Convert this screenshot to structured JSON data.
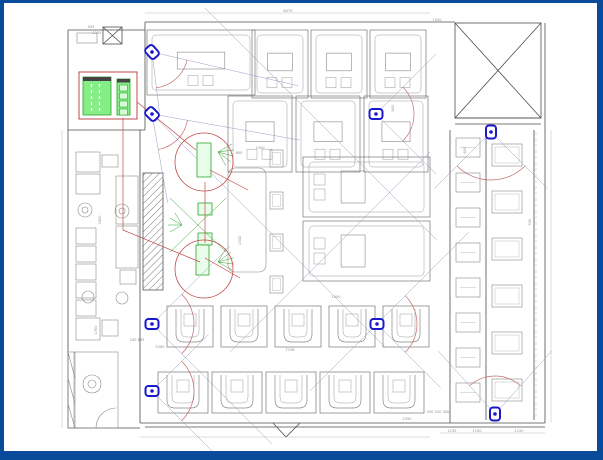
{
  "drawing": {
    "title": "security-camera-floor-plan",
    "colors": {
      "frame_blue": "#0a4a9b",
      "wall": "#4d4d4d",
      "furniture": "#8a8a8a",
      "light": "#b0b0b0",
      "camera_blue": "#1a1acc",
      "fov_line": "#9a9ac8",
      "arc_red": "#c46a6a",
      "annot_red": "#c04848",
      "green_fill": "#86ee86",
      "green_stroke": "#2da52d",
      "green_light": "#d9fbd9",
      "dim_text": "#909090",
      "dim_line": "#aaaaaa",
      "header_bar": "#444444"
    },
    "cameras": [
      {
        "id": "cam-1",
        "x": 152,
        "y": 52,
        "dir": 48,
        "half": 35,
        "len_a": 150,
        "len_b": 60,
        "arc_r": 36
      },
      {
        "id": "cam-2",
        "x": 152,
        "y": 114,
        "dir": 45,
        "half": 35,
        "len_a": 150,
        "len_b": 90,
        "arc_r": 36
      },
      {
        "id": "cam-3",
        "x": 376,
        "y": 114,
        "dir": 0,
        "half": 45,
        "len_a": 85,
        "len_b": 85,
        "arc_r": 38
      },
      {
        "id": "cam-4",
        "x": 491,
        "y": 132,
        "dir": 90,
        "half": 45,
        "len_a": 80,
        "len_b": 80,
        "arc_r": 48
      },
      {
        "id": "cam-5",
        "x": 152,
        "y": 324,
        "dir": 0,
        "half": 45,
        "len_a": 110,
        "len_b": 170,
        "arc_r": 42
      },
      {
        "id": "cam-6",
        "x": 377,
        "y": 324,
        "dir": 0,
        "half": 45,
        "len_a": 130,
        "len_b": 90,
        "arc_r": 40
      },
      {
        "id": "cam-7",
        "x": 152,
        "y": 391,
        "dir": 0,
        "half": 45,
        "len_a": 80,
        "len_b": 92,
        "arc_r": 42
      },
      {
        "id": "cam-8",
        "x": 495,
        "y": 414,
        "dir": -90,
        "half": 42,
        "len_a": 85,
        "len_b": 85,
        "arc_r": 38
      }
    ],
    "sight_lines": [
      [
        205,
        8,
        437,
        240
      ],
      [
        152,
        114,
        385,
        347
      ],
      [
        430,
        152,
        230,
        352
      ],
      [
        469,
        232,
        310,
        391
      ]
    ],
    "booth_rows": [
      {
        "style": "A",
        "x": 147,
        "y": 30,
        "w": 108,
        "h": 65,
        "count": 1,
        "gap": 0,
        "stack": "h"
      },
      {
        "style": "A",
        "x": 252,
        "y": 30,
        "w": 56,
        "h": 68,
        "count": 3,
        "gap": 3,
        "stack": "h"
      },
      {
        "style": "A",
        "x": 228,
        "y": 96,
        "w": 64,
        "h": 76,
        "count": 3,
        "gap": 4,
        "stack": "h"
      },
      {
        "style": "M",
        "x": 303,
        "y": 157,
        "w": 127,
        "h": 60,
        "count": 2,
        "gap": 4,
        "stack": "v"
      },
      {
        "style": "T",
        "x": 270,
        "y": 150,
        "w": 13,
        "h": 17,
        "count": 4,
        "gap": 25,
        "stack": "v"
      },
      {
        "style": "U",
        "x": 167,
        "y": 306,
        "w": 46,
        "h": 41,
        "count": 5,
        "gap": 8,
        "stack": "h"
      },
      {
        "style": "U",
        "x": 158,
        "y": 372,
        "w": 50,
        "h": 41,
        "count": 5,
        "gap": 4,
        "stack": "h"
      },
      {
        "style": "R1",
        "x": 456,
        "y": 138,
        "w": 24,
        "h": 19,
        "count": 8,
        "gap": 16,
        "stack": "v"
      },
      {
        "style": "R2",
        "x": 492,
        "y": 144,
        "w": 30,
        "h": 22,
        "count": 6,
        "gap": 25,
        "stack": "v"
      }
    ],
    "legend": {
      "box": [
        79,
        72,
        58,
        47
      ],
      "green_table": [
        83,
        77,
        28,
        38
      ],
      "green_column": [
        117,
        79,
        13,
        36
      ],
      "column_cells": [
        [
          119.5,
          85,
          8,
          6
        ],
        [
          119.5,
          93,
          8,
          6
        ],
        [
          119.5,
          101,
          8,
          6
        ],
        [
          119.5,
          109,
          8,
          6
        ]
      ]
    },
    "red_circles": [
      {
        "cx": 204,
        "cy": 162,
        "r": 29
      },
      {
        "cx": 204,
        "cy": 269,
        "r": 29
      }
    ],
    "red_lines": [
      [
        123,
        118,
        123,
        230
      ],
      [
        123,
        230,
        200,
        262
      ],
      [
        137,
        102,
        196,
        150
      ],
      [
        205,
        182,
        205,
        243
      ],
      [
        210,
        170,
        248,
        190
      ],
      [
        205,
        258,
        240,
        278
      ]
    ],
    "green_rects": [
      [
        197,
        143,
        14,
        34
      ],
      [
        198,
        203,
        14,
        12
      ],
      [
        198,
        233,
        14,
        12
      ],
      [
        196,
        245,
        13,
        30
      ]
    ],
    "green_lines": [
      [
        170,
        198,
        226,
        252
      ],
      [
        226,
        198,
        170,
        252
      ]
    ],
    "green_fans": [
      {
        "cx": 218,
        "cy": 152,
        "a0": -30,
        "a1": 60,
        "n": 5,
        "r": 16
      },
      {
        "cx": 218,
        "cy": 262,
        "a0": -60,
        "a1": 30,
        "n": 5,
        "r": 16
      },
      {
        "cx": 182,
        "cy": 225,
        "a0": 150,
        "a1": 240,
        "n": 4,
        "r": 14
      }
    ],
    "dimensions": [
      {
        "t": "8070",
        "x": 288,
        "y": 12,
        "r": 0
      },
      {
        "t": "1500",
        "x": 437,
        "y": 21,
        "r": 0
      },
      {
        "t": "943",
        "x": 91,
        "y": 28,
        "r": 0
      },
      {
        "t": "1205",
        "x": 97,
        "y": 34,
        "r": 0
      },
      {
        "t": "3400",
        "x": 101,
        "y": 220,
        "r": -90
      },
      {
        "t": "1700",
        "x": 97,
        "y": 330,
        "r": -90
      },
      {
        "t": "2042",
        "x": 241,
        "y": 240,
        "r": -90
      },
      {
        "t": "600",
        "x": 239,
        "y": 154,
        "r": 0
      },
      {
        "t": "1500",
        "x": 260,
        "y": 149,
        "r": 0
      },
      {
        "t": "800",
        "x": 394,
        "y": 108,
        "r": -90
      },
      {
        "t": "600",
        "x": 466,
        "y": 150,
        "r": -90
      },
      {
        "t": "930",
        "x": 531,
        "y": 222,
        "r": -90
      },
      {
        "t": "1400",
        "x": 336,
        "y": 298,
        "r": 0
      },
      {
        "t": "5280",
        "x": 160,
        "y": 348,
        "r": 0
      },
      {
        "t": "7158",
        "x": 290,
        "y": 351,
        "r": 0
      },
      {
        "t": "240 895",
        "x": 137,
        "y": 341,
        "r": 0
      },
      {
        "t": "2350",
        "x": 407,
        "y": 420,
        "r": 0
      },
      {
        "t": "200 200 300",
        "x": 438,
        "y": 413,
        "r": 0
      },
      {
        "t": "1135",
        "x": 452,
        "y": 432,
        "r": 0
      },
      {
        "t": "1100",
        "x": 477,
        "y": 432,
        "r": 0
      },
      {
        "t": "1150",
        "x": 519,
        "y": 432,
        "r": 0
      }
    ]
  }
}
